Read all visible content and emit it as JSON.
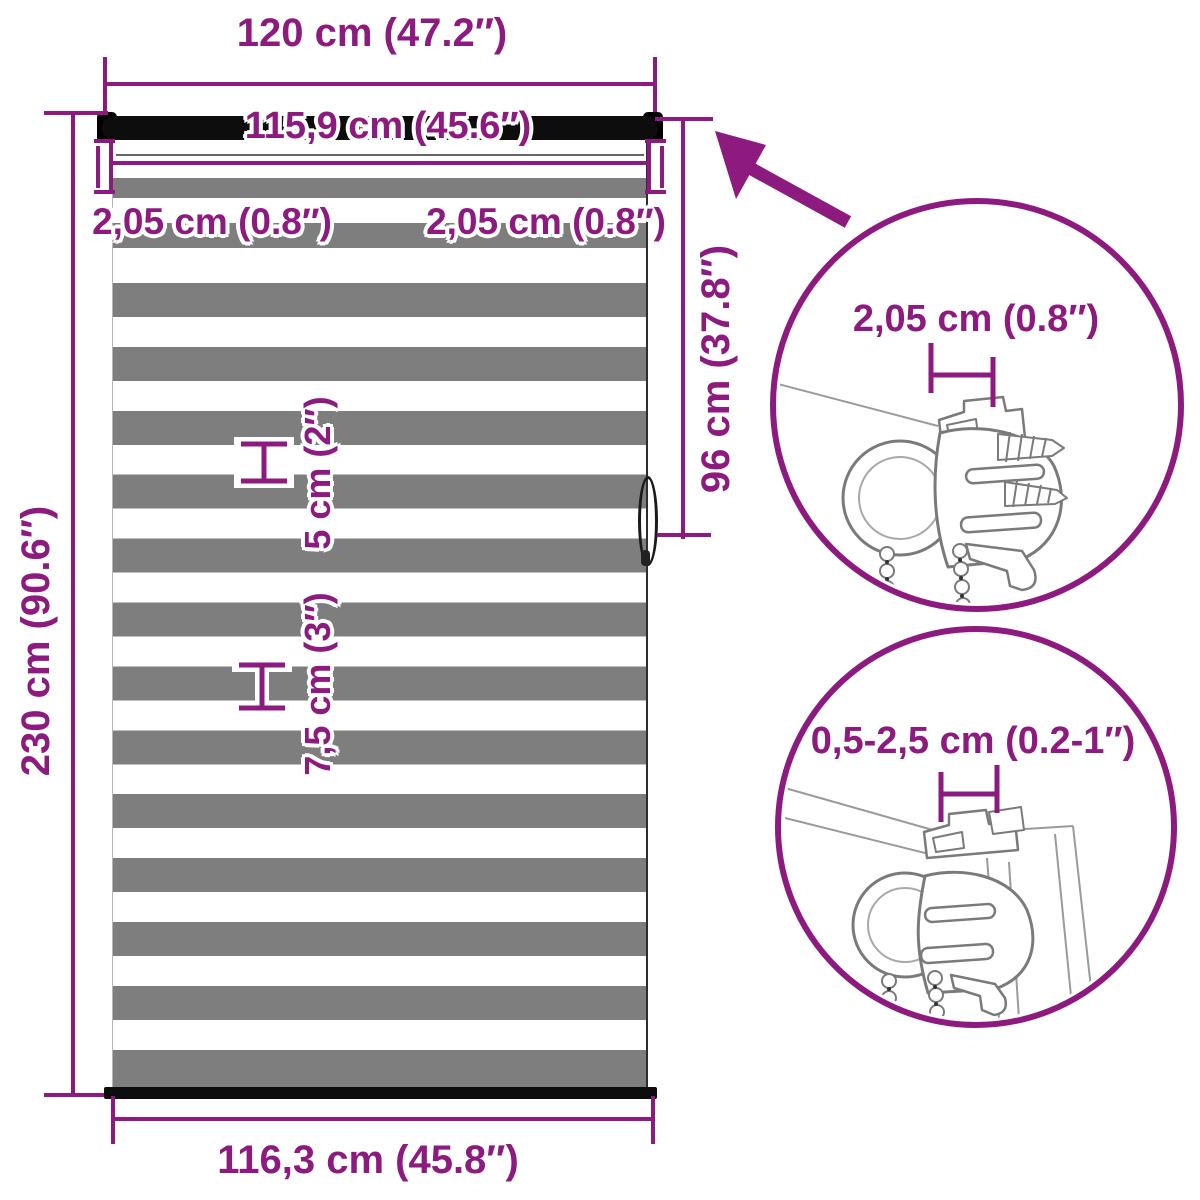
{
  "diagram": {
    "unit_labels": {
      "top_width": "120 cm (47.2″)",
      "roller_width": "115,9 cm (45.6″)",
      "bracket_width_left": "2,05 cm (0.8″)",
      "bracket_width_right": "2,05 cm (0.8″)",
      "drop_height": "230 cm (90.6″)",
      "partial_height": "96 cm (37.8″)",
      "white_stripe_height": "5 cm (2″)",
      "gray_stripe_height": "7,5 cm (3″)",
      "bottom_width": "116,3 cm (45.8″)",
      "detail_top_bracket_width": "2,05 cm (0.8″)",
      "detail_mount_depth": "0,5-2,5 cm (0.2-1″)"
    },
    "colors": {
      "accent": "#8d1a7f",
      "stripe_gray": "#7e7e7e",
      "bar_black": "#0d0d0d",
      "sketch_gray": "#8a8a8a"
    }
  }
}
